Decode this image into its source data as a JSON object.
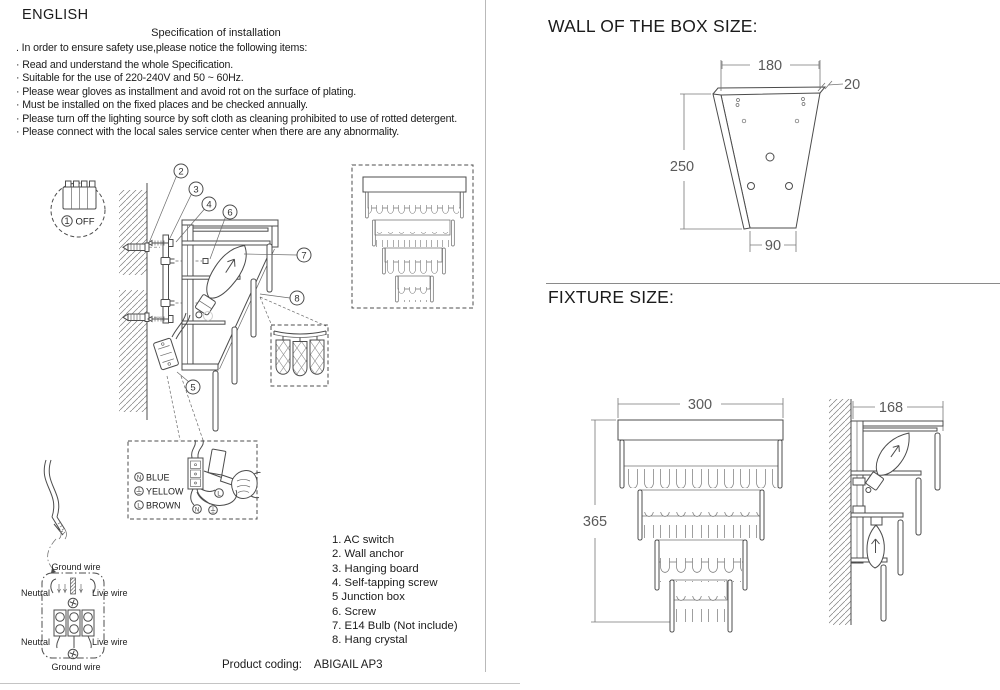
{
  "colors": {
    "ink": "#1b1b1b",
    "line": "#4c4c4c",
    "dim": "#5a5a5a",
    "divider": "#b9b9b9"
  },
  "left": {
    "language": "ENGLISH",
    "title": "Specification of installation",
    "notices": [
      ". In order to ensure safety use,please notice the following items:",
      "· Read and understand the whole Specification.",
      "· Suitable for the use of 220-240V and 50 ~ 60Hz.",
      "· Please wear gloves as installment and avoid rot on the surface of plating.",
      "· Must be installed on the fixed places and be checked annually.",
      "· Please turn off the lighting source by soft cloth as cleaning prohibited to use of rotted detergent.",
      "· Please connect with the local sales service center when there are any abnormality."
    ]
  },
  "figure": {
    "switch": {
      "number": "1",
      "label": "OFF"
    },
    "callouts": {
      "c2": "2",
      "c3": "3",
      "c4": "4",
      "c5": "5",
      "c6": "6",
      "c7": "7",
      "c8": "8"
    },
    "legend": {
      "n": "N",
      "blue": "BLUE",
      "yellow": "YELLOW",
      "l": "L",
      "brown": "BROWN"
    },
    "terminal_letters": {
      "n": "N",
      "l": "L"
    },
    "wire_labels": {
      "ground": "Ground wire",
      "neutral": "Neutral",
      "live": "Live wire"
    }
  },
  "parts": [
    "1. AC switch",
    "2. Wall anchor",
    "3. Hanging board",
    "4. Self-tapping screw",
    "5 Junction box",
    "6. Screw",
    "7. E14 Bulb (Not include)",
    "8. Hang crystal"
  ],
  "product": {
    "label": "Product coding:",
    "value": "ABIGAIL AP3"
  },
  "wall_box": {
    "heading": "WALL OF THE BOX SIZE:",
    "dim_top": "180",
    "dim_depth": "20",
    "dim_height": "250",
    "dim_bottom": "90"
  },
  "fixture": {
    "heading": "FIXTURE SIZE:",
    "dim_width": "300",
    "dim_height": "365",
    "dim_depth": "168"
  }
}
